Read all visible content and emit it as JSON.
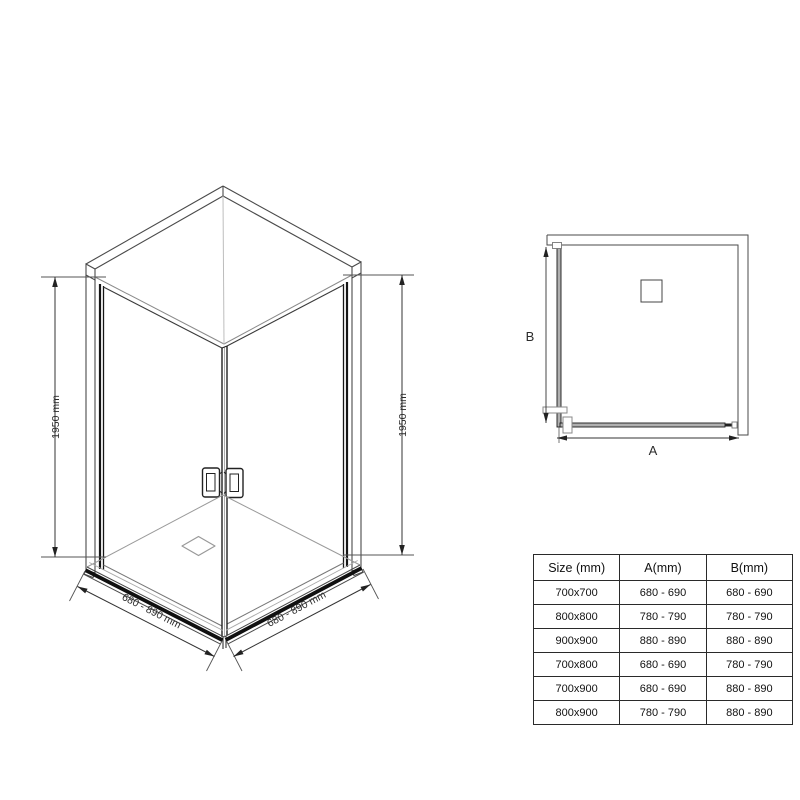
{
  "iso_view": {
    "height_label_left": "1950 mm",
    "height_label_right": "1950 mm",
    "width_label_left": "680 - 890 mm",
    "width_label_right": "680 - 890 mm"
  },
  "plan_view": {
    "width_label": "A",
    "depth_label": "B"
  },
  "size_table": {
    "headers": [
      "Size (mm)",
      "A(mm)",
      "B(mm)"
    ],
    "rows": [
      {
        "size": "700x700",
        "a": "680 - 690",
        "b": "680 - 690"
      },
      {
        "size": "800x800",
        "a": "780 - 790",
        "b": "780 - 790"
      },
      {
        "size": "900x900",
        "a": "880 - 890",
        "b": "880 - 890"
      },
      {
        "size": "700x800",
        "a": "680 - 690",
        "b": "780 - 790"
      },
      {
        "size": "700x900",
        "a": "680 - 690",
        "b": "880 - 890"
      },
      {
        "size": "800x900",
        "a": "780 - 790",
        "b": "880 - 890"
      }
    ]
  },
  "colors": {
    "thin_line": "#4a4a4a",
    "dark_line": "#111111",
    "light_line": "#9a9a9a",
    "dim_line": "#333333"
  }
}
